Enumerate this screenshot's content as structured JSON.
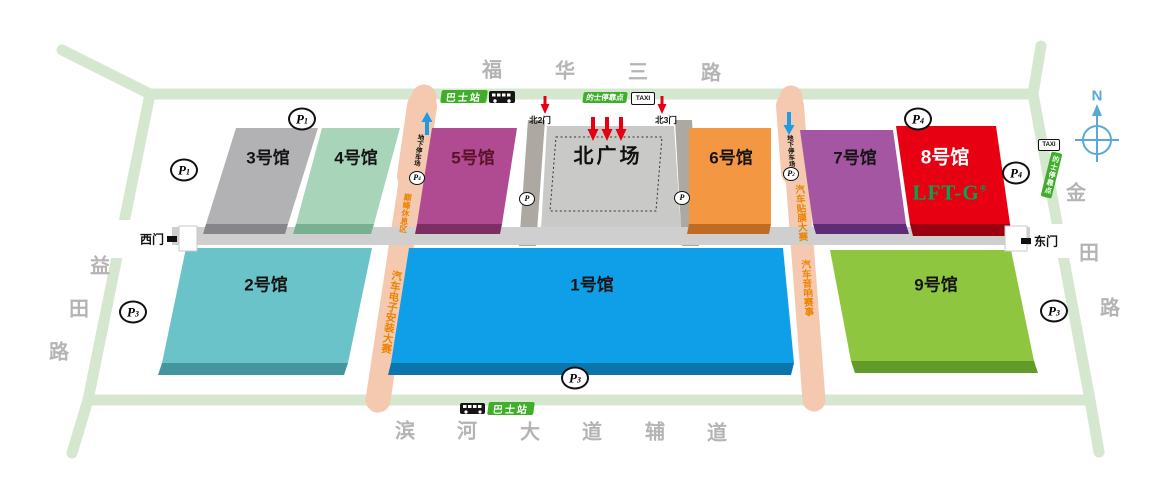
{
  "roads": {
    "top_chars": [
      "福",
      "华",
      "三",
      "路"
    ],
    "bottom_chars": [
      "滨",
      "河",
      "大",
      "道",
      "辅",
      "道"
    ],
    "left_chars": [
      "益",
      "田",
      "路"
    ],
    "right_chars": [
      "金",
      "田",
      "路"
    ]
  },
  "halls": [
    {
      "label": "3号馆",
      "color": "#b2b2b4",
      "side": "#86868a"
    },
    {
      "label": "4号馆",
      "color": "#a8d4ba",
      "side": "#78b092"
    },
    {
      "label": "5号馆",
      "color": "#b04b91",
      "side": "#7c2f63",
      "label_color": "#5a1228"
    },
    {
      "label": "6号馆",
      "color": "#f49742",
      "side": "#c06b24"
    },
    {
      "label": "7号馆",
      "color": "#a556a3",
      "side": "#5f2d75"
    },
    {
      "label": "8号馆",
      "color": "#e60012",
      "side": "#9a0010",
      "label_color": "#ffffff",
      "brand": "LFT-G",
      "brand_reg": "®",
      "brand_color": "#00a651"
    },
    {
      "label": "9号馆",
      "color": "#8ec73f",
      "side": "#639b28"
    },
    {
      "label": "1号馆",
      "color": "#0f9fe8",
      "side": "#0b76ad"
    },
    {
      "label": "2号馆",
      "color": "#69c3c8",
      "side": "#43969d"
    }
  ],
  "plaza": {
    "label": "北广场"
  },
  "gates": {
    "west": "西门",
    "east": "东门",
    "north2": "北2门",
    "north3": "北3门"
  },
  "transit": {
    "bus_station": "巴士站",
    "taxi_stop": "的士停靠点",
    "taxi_sign": "TAXI"
  },
  "strips": {
    "underground": "地下停车场",
    "rest_area": "巅峰休息区",
    "electronics": "汽车电子安装大赛",
    "film": "汽车贴膜大赛",
    "audio": "汽车音响赛事"
  },
  "parking": {
    "letter": "P",
    "sub_1": "1",
    "sub_2": "2",
    "sub_3": "3",
    "sub_4": "4"
  },
  "compass": {
    "north": "N"
  },
  "colors": {
    "road": "#d5e7cf",
    "strip": "#f5c9af",
    "concourse": "#cfcfcf",
    "walkway": "#ada8a2",
    "plaza": "#c9c9c7",
    "badge_green": "#3fae2a",
    "arrow_red": "#e60012",
    "arrow_blue": "#1e9be2",
    "compass_blue": "#58a9d8",
    "brand_green": "#00a651"
  }
}
